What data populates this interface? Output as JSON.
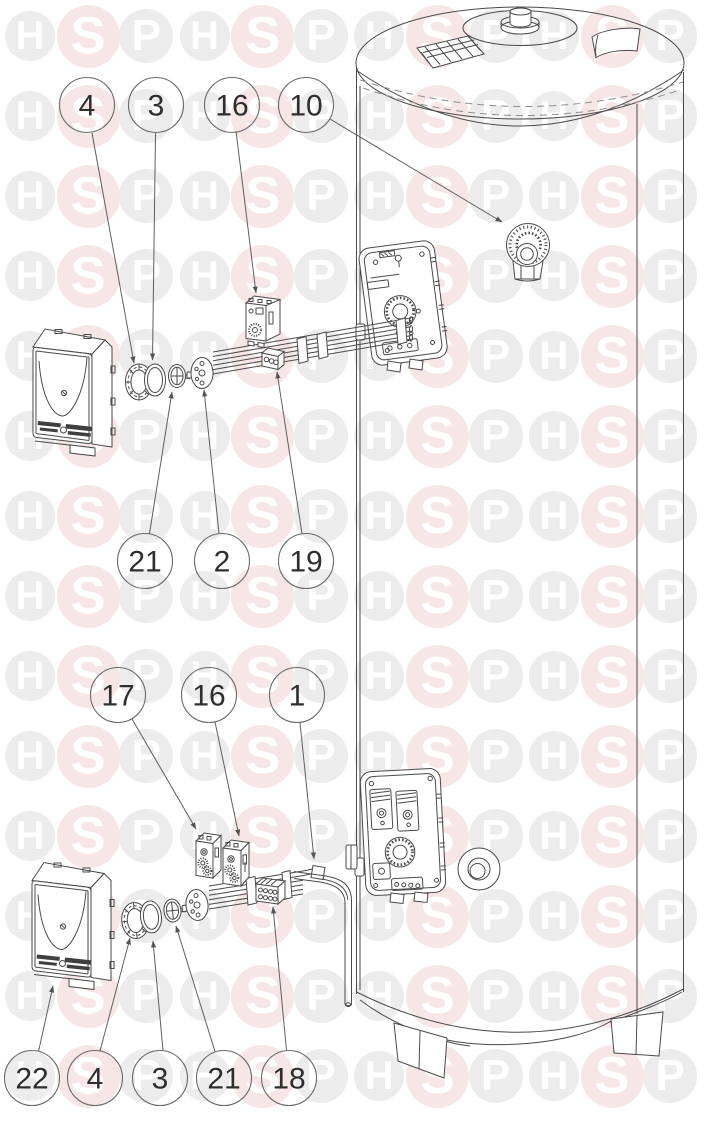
{
  "callouts": [
    {
      "label": "4"
    },
    {
      "label": "3"
    },
    {
      "label": "16"
    },
    {
      "label": "10"
    },
    {
      "label": "21"
    },
    {
      "label": "2"
    },
    {
      "label": "19"
    },
    {
      "label": "17"
    },
    {
      "label": "16"
    },
    {
      "label": "1"
    },
    {
      "label": "22"
    },
    {
      "label": "4"
    },
    {
      "label": "3"
    },
    {
      "label": "21"
    },
    {
      "label": "18"
    }
  ],
  "watermark": {
    "letters": [
      "H",
      "S",
      "P"
    ],
    "letter_color": "#ffffff",
    "circles": {
      "H": {
        "diameter": 50,
        "bg": "#ececec",
        "font_size": 40
      },
      "S": {
        "diameter": 63,
        "bg": "#f7e6e6",
        "font_size": 52
      },
      "P": {
        "diameter": 54,
        "bg": "#ececec",
        "font_size": 44
      }
    }
  },
  "colors": {
    "background": "#ffffff",
    "line": "#4a4a4a",
    "leader": "#5f5f5f",
    "callout_circle": "#6a6a6a",
    "callout_text": "#2e2e2e",
    "label_bar": "#3f3f3f"
  }
}
